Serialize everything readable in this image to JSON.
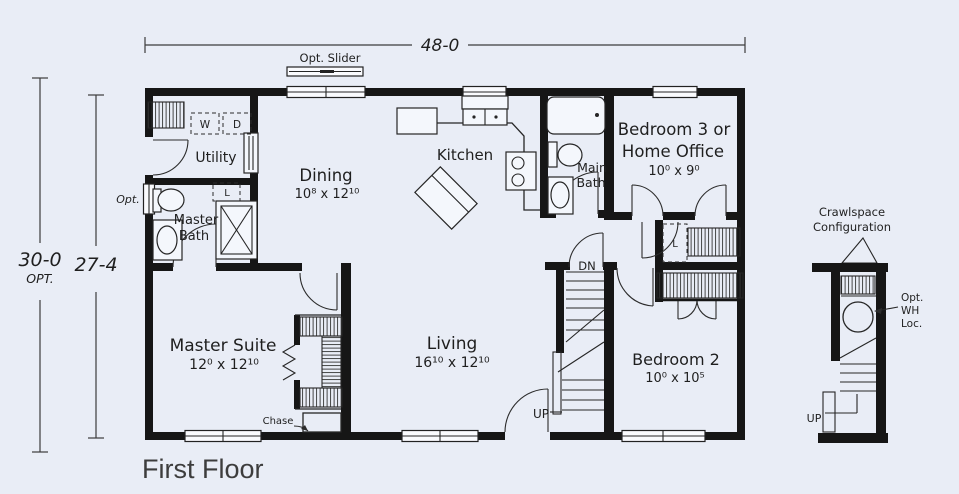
{
  "title": "First Floor",
  "colors": {
    "background": "#e9edf6",
    "wall": "#161616",
    "line": "#2a2a2a",
    "text": "#1f1f1f"
  },
  "dimensions": {
    "overall_width": "48-0",
    "depth_optional": "30-0",
    "depth_optional_suffix": "OPT.",
    "depth_standard": "27-4"
  },
  "labels": {
    "opt_slider": "Opt. Slider",
    "opt_window": "Opt.",
    "washer": "W",
    "dryer": "D",
    "linen_master_bath": "L",
    "linen_hall": "L",
    "stairs_down": "DN",
    "stairs_up": "UP",
    "chase": "Chase",
    "crawlspace_title_line1": "Crawlspace",
    "crawlspace_title_line2": "Configuration",
    "water_heater_line1": "Opt.",
    "water_heater_line2": "WH",
    "water_heater_line3": "Loc.",
    "crawlspace_up": "UP"
  },
  "rooms": {
    "utility": {
      "name": "Utility"
    },
    "dining": {
      "name": "Dining",
      "dims": "10⁸ x 12¹⁰"
    },
    "kitchen": {
      "name": "Kitchen"
    },
    "main_bath": {
      "name_line1": "Main",
      "name_line2": "Bath"
    },
    "bedroom3": {
      "name_line1": "Bedroom 3 or",
      "name_line2": "Home Office",
      "dims": "10⁰ x 9⁰"
    },
    "master_bath": {
      "name_line1": "Master",
      "name_line2": "Bath"
    },
    "master_suite": {
      "name": "Master Suite",
      "dims": "12⁰ x 12¹⁰"
    },
    "living": {
      "name": "Living",
      "dims": "16¹⁰ x 12¹⁰"
    },
    "bedroom2": {
      "name": "Bedroom 2",
      "dims": "10⁰ x 10⁵"
    }
  }
}
